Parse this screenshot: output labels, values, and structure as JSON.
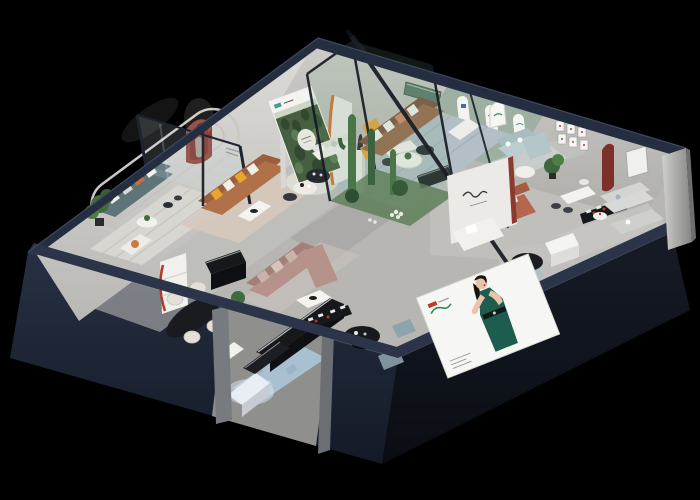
{
  "scene": {
    "type": "isometric-cutaway-3d-render",
    "subject": "furniture showroom interior, dollhouse view, night/black backdrop",
    "rooms": [
      "teal-sofa-lounge",
      "caramel-sofa-living-room",
      "forest-poster-room",
      "brown-sofa-living-room",
      "pale-blue-sofa-glass-room",
      "cactus-glass-atrium",
      "mauve-sectional-area",
      "dining-area",
      "front-display-walkway",
      "gray-sofa-suite"
    ],
    "signage": [
      "forest-photo-poster-with-emblem",
      "brand-script-partition-logo",
      "woman-in-green-dress-billboard",
      "arched-mini-sign",
      "wall-picture-grid"
    ]
  },
  "palette": {
    "background": "#000000",
    "exterior_front_left": "#1d2534",
    "exterior_front_right": "#10141d",
    "wall_top": "#252e40",
    "back_wall": "#d0cfcb",
    "back_wall_right": "#c2c1be",
    "floor": "#b7b6b3",
    "floor_opening": "#8f8f8e",
    "column_gray": "#b0b0ae",
    "sofa_teal": "#5d7478",
    "sofa_caramel": "#b07048",
    "sofa_brown": "#996a4d",
    "sofa_mauve": "#b5928a",
    "sofa_pale_blue": "#bccdd0",
    "sofa_white": "#efefec",
    "sofa_gray": "#d8d8d6",
    "bench_terracotta": "#b5674e",
    "accent_yellow": "#e8a33c",
    "accent_orange": "#d2743a",
    "arch_red": "#8c3a30",
    "sage_wall": "#9db0a2",
    "forest_green": "#475f41",
    "rug_blue_gray": "#b3bec6",
    "rug_blue": "#a9c0d1",
    "glass_green": "#6ea578",
    "cactus_green": "#4a7548",
    "plant_green": "#3f6b3f",
    "billboard_white": "#f6f6f4",
    "dress_green": "#1d5c4e",
    "hair_black": "#17120f",
    "skin": "#e8c4a8",
    "logo_red": "#c0392b",
    "logo_teal": "#3aa08f",
    "bench_black": "#17181c",
    "vitrine_glow": "#e8eef4",
    "pouf_blue": "#8fa3ad"
  }
}
